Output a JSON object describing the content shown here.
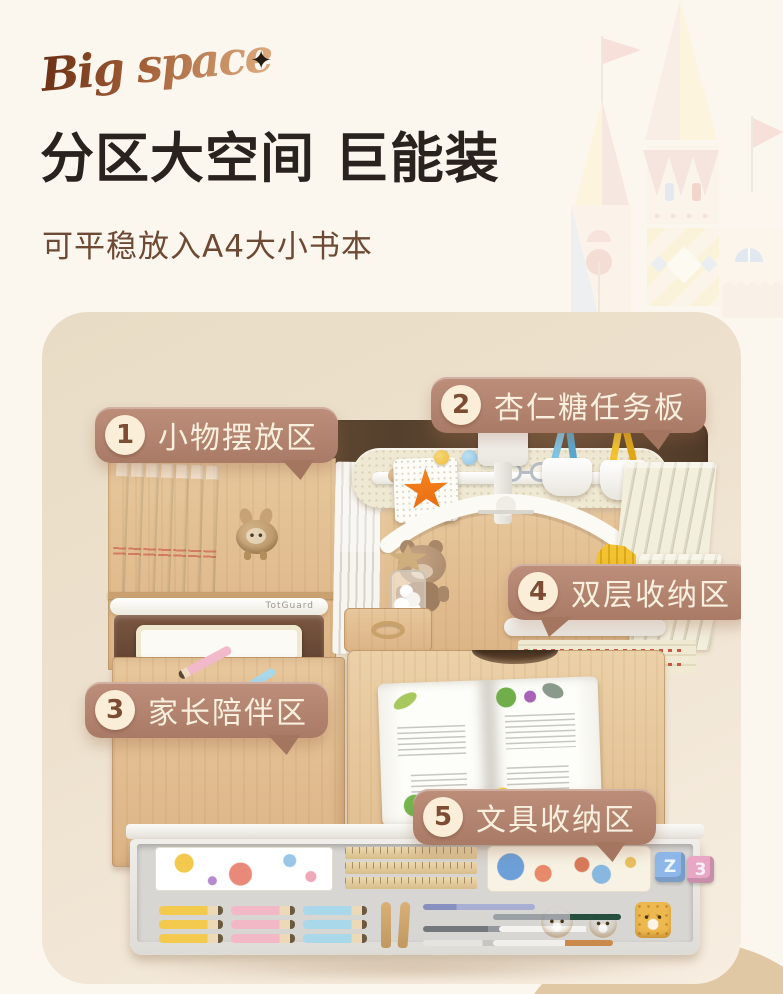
{
  "header": {
    "logo_text": "Big space",
    "sparkle": "✦",
    "title": "分区大空间 巨能装",
    "subtitle": "可平稳放入A4大小书本"
  },
  "callouts": [
    {
      "num": "1",
      "label": "小物摆放区"
    },
    {
      "num": "2",
      "label": "杏仁糖任务板"
    },
    {
      "num": "3",
      "label": "家长陪伴区"
    },
    {
      "num": "4",
      "label": "双层收纳区"
    },
    {
      "num": "5",
      "label": "文具收纳区"
    }
  ],
  "product": {
    "tray_brand": "TotGuard",
    "block_letters": [
      "Z",
      "3"
    ]
  },
  "colors": {
    "page_bg": "#fbf7ee",
    "card_bg_top": "#e8dcc5",
    "card_bg_bottom": "#f7eee1",
    "callout_bg": "#b28270",
    "callout_text": "#f9efde",
    "title_color": "#29221f",
    "subtitle_color": "#6e4a35",
    "logo_brown": "#8a4a28",
    "star_orange": "#f07a1a"
  }
}
